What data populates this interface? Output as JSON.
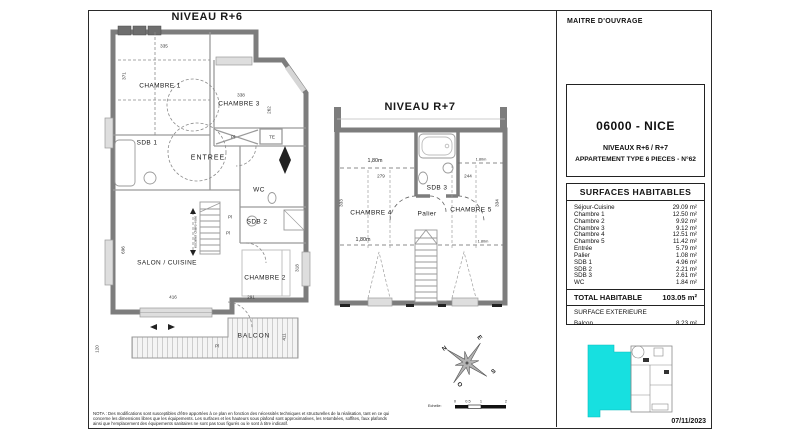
{
  "plans": {
    "r6": {
      "title": "NIVEAU R+6",
      "rooms": {
        "chambre1": "CHAMBRE 1",
        "chambre2": "CHAMBRE 2",
        "chambre3": "CHAMBRE 3",
        "sdb1": "SDB 1",
        "sdb2": "SDB 2",
        "wc": "WC",
        "entree": "ENTREE",
        "salon": "SALON / CUISINE",
        "balcon": "BALCON",
        "escalier": "escalier claire-voie",
        "pl": "Pl",
        "te": "TE"
      },
      "dims": {
        "d335": "335",
        "d371": "371",
        "d338": "338",
        "d262": "262",
        "d696": "696",
        "d416": "416",
        "d291": "291",
        "d318": "318",
        "d120": "120",
        "d411": "411"
      }
    },
    "r7": {
      "title": "NIVEAU R+7",
      "rooms": {
        "chambre4": "CHAMBRE 4",
        "chambre5": "CHAMBRE 5",
        "sdb3": "SDB 3",
        "palier": "Palier"
      },
      "dims": {
        "d279": "279",
        "d244": "244",
        "d333": "333",
        "d334": "334",
        "h_left_top": "1,80m",
        "h_right_top": "1.80m",
        "h_left_bottom": "1,80m",
        "h_right_bottom": "1.80m"
      }
    }
  },
  "compass": {
    "n": "N",
    "e": "E",
    "s": "S",
    "o": "O"
  },
  "scale_bar": {
    "label": "Echelle:",
    "ticks": [
      "0",
      "0.5",
      "1",
      "2"
    ]
  },
  "nota": "NOTA : Des modifications sont susceptibles d'être apportées à ce plan en fonction des nécessités techniques et structurelles de la réalisation, tant en ce qui concerne les dimensions libres que les équipements. Les surfaces et les hauteurs sous plafond sont approximatives, les retombées, soffites, faux plafonds ainsi que l'emplacement des équipements sanitaires ne sont pas tous figurés ou le sont à titre indicatif.",
  "title_block": {
    "owner_label": "MAITRE D'OUVRAGE",
    "project": {
      "city": "06000 - NICE",
      "levels": "NIVEAUX R+6 / R+7",
      "apartment": "APPARTEMENT TYPE 6 PIECES - N°62"
    },
    "surfaces": {
      "title": "SURFACES HABITABLES",
      "rows": [
        {
          "label": "Séjour-Cuisine",
          "value": "29.09 m²"
        },
        {
          "label": "Chambre 1",
          "value": "12.50 m²"
        },
        {
          "label": "Chambre 2",
          "value": "9.92 m²"
        },
        {
          "label": "Chambre 3",
          "value": "9.12 m²"
        },
        {
          "label": "Chambre 4",
          "value": "12.51 m²"
        },
        {
          "label": "Chambre 5",
          "value": "11.42 m²"
        },
        {
          "label": "Entrée",
          "value": "5.79 m²"
        },
        {
          "label": "Palier",
          "value": "1.08 m²"
        },
        {
          "label": "SDB 1",
          "value": "4.96 m²"
        },
        {
          "label": "SDB 2",
          "value": "2.21 m²"
        },
        {
          "label": "SDB 3",
          "value": "2.61 m²"
        },
        {
          "label": "WC",
          "value": "1.84 m²"
        }
      ],
      "total_label": "TOTAL HABITABLE",
      "total_value": "103.05 m²",
      "exterior_title": "SURFACE EXTERIEURE",
      "exterior_rows": [
        {
          "label": "Balcon",
          "value": "8.23 m²"
        }
      ]
    },
    "date": "07/11/2023"
  }
}
